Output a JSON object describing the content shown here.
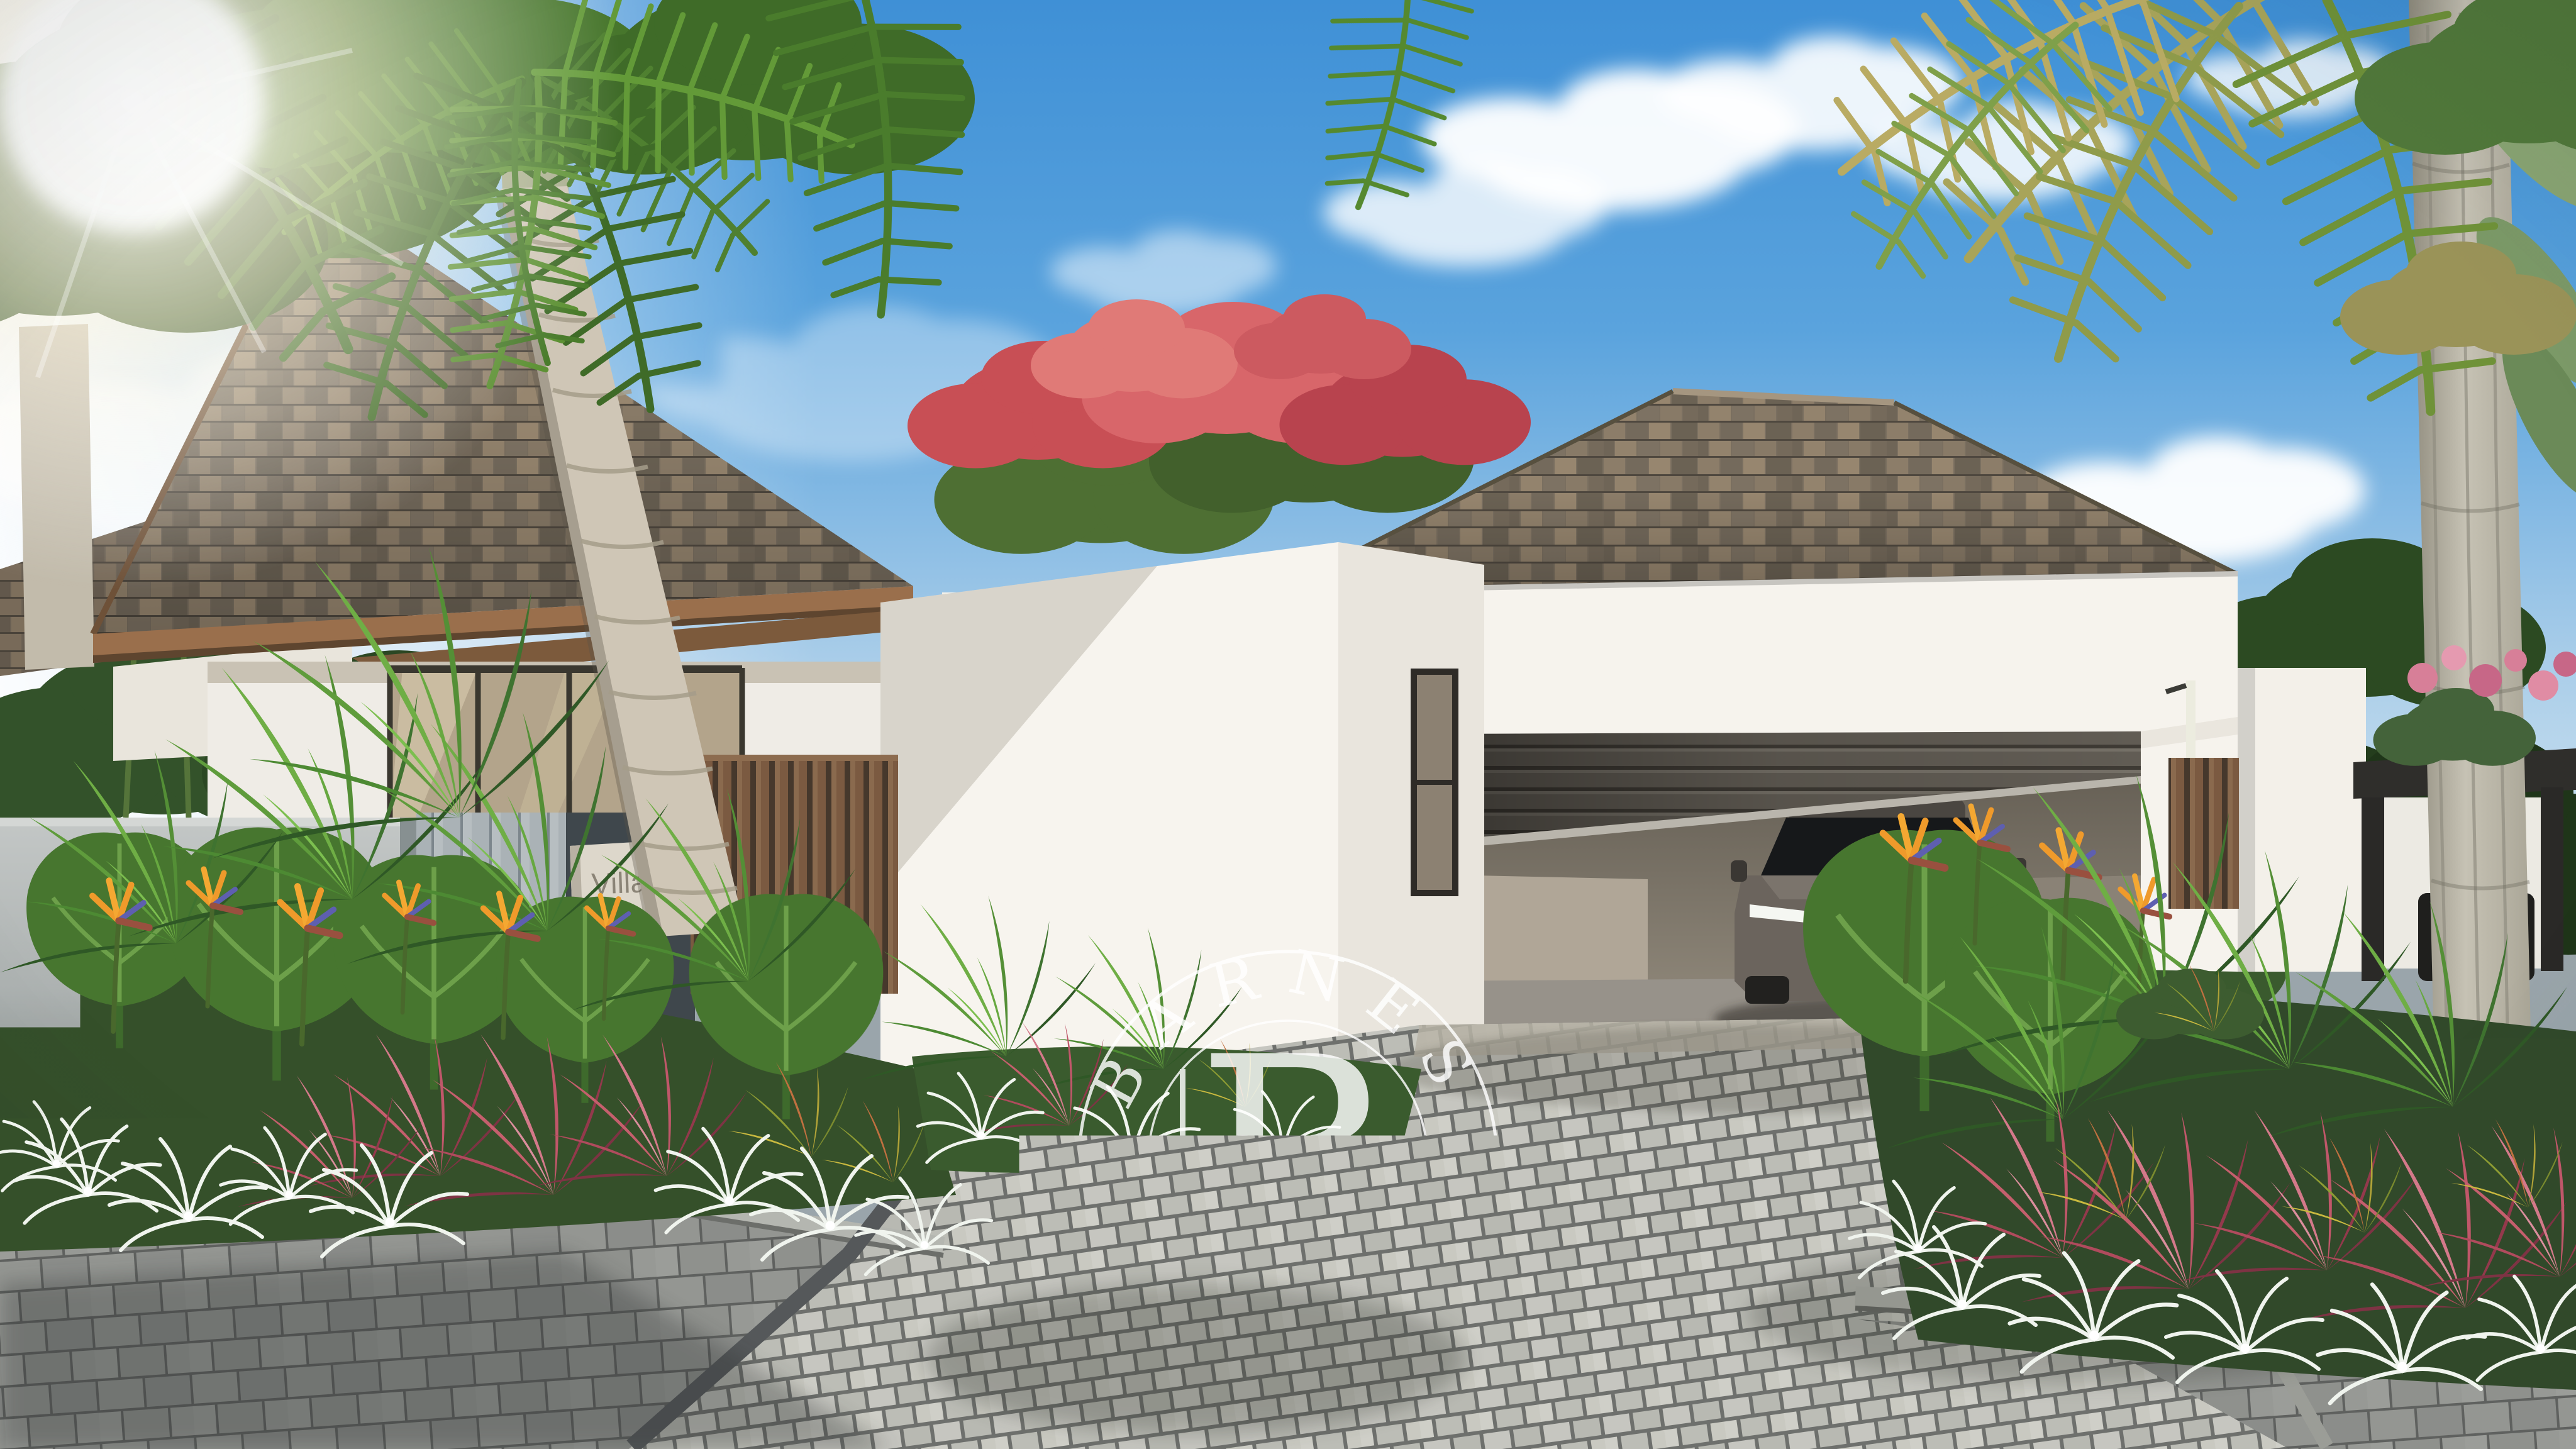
{
  "watermark": {
    "arc_top": "BARNES",
    "monogram": "B",
    "arc_bottom": "INTERNATIONAL",
    "color": "#ffffff"
  },
  "villa_sign": {
    "line1": "Villa",
    "line2": "01",
    "plaque_color": "#ddd7cb",
    "text_color": "#8b8477"
  },
  "palette": {
    "sky_blue": "#4092d8",
    "sky_haze": "#e9f2f7",
    "cloud_white": "#ffffff",
    "roof_shingle_brown": "#857868",
    "roof_fascia_wood": "#9a6f4c",
    "wall_white": "#f6f3ed",
    "concrete_wall_gray": "#b6babb",
    "plank_wall_gray": "#a7afb3",
    "wood_slat_brown": "#7b5a41",
    "roller_door_gray": "#5d5850",
    "garage_interior_taupe": "#a79d8f",
    "car_body_gray": "#6b645d",
    "grille_bronze": "#b9a57e",
    "street_paver_gray": "#90928f",
    "driveway_sett_gray": "#c3c3bc",
    "lawn_green": "#6f9348",
    "foliage_dark": "#2f4a26",
    "foliage_mid": "#4e7a31",
    "foliage_light": "#7fb04e",
    "flamboyant_red": "#c84f55",
    "cordyline_pink": "#b95565",
    "croton_yellow": "#c2b23b",
    "bird_of_paradise_orange": "#ef9a2b",
    "spider_lily_white": "#eef2ec",
    "palm_trunk": "#c9c1b1"
  }
}
